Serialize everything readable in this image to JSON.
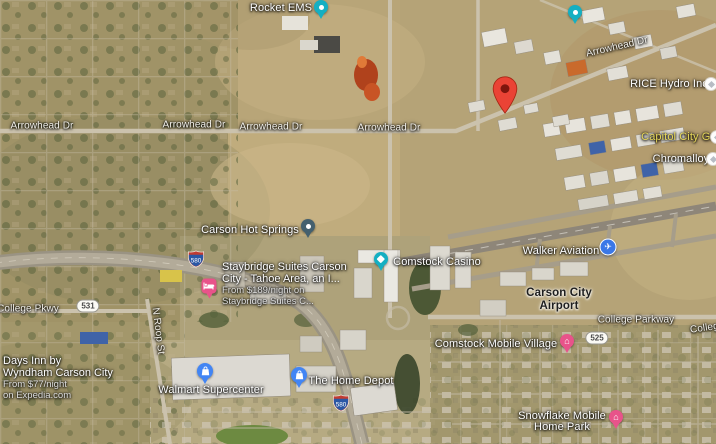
{
  "map_type": "satellite",
  "colors": {
    "marker_red": "#EA4335",
    "pin_teal": "#14afc2",
    "pin_slate": "#44606e",
    "pin_pink": "#e8538a",
    "pin_blue": "#4285f4",
    "poi_circle_blue": "#3b78e7",
    "label_yellow": "#e6d75a",
    "interstate_blue": "#2a57a5",
    "interstate_red": "#c03b31"
  },
  "road_labels": {
    "arrowhead": "Arrowhead Dr",
    "college_pkwy": "College Pkwy",
    "college_parkway": "College Parkway",
    "n_roop_st": "N Roop St"
  },
  "shields": {
    "interstate_580": "580",
    "route_531": "531",
    "route_525": "525"
  },
  "places": {
    "rocket_ems": "Rocket EMS",
    "rice_hydro": "RICE Hydro Inc",
    "capitol_city_gun": "Capitol City Gun",
    "chromalloy": "Chromalloy",
    "carson_hot_springs": "Carson Hot Springs",
    "comstock_casino": "Comstock Casino",
    "walker_aviation": "Walker Aviation",
    "airport_line1": "Carson City",
    "airport_line2": "Airport",
    "comstock_mobile_village": "Comstock Mobile Village",
    "snowflake_line1": "Snowflake Mobile",
    "snowflake_line2": "Home Park",
    "walmart": "Walmart Supercenter",
    "home_depot": "The Home Depot"
  },
  "ads": {
    "staybridge": {
      "title_line1": "Staybridge Suites Carson",
      "title_line2": "City - Tahoe Area, an I...",
      "price_line": "From $189/night on",
      "source_line": "Staybridge Suites C..."
    },
    "days_inn": {
      "title_line1": "Days Inn by",
      "title_line2": "Wyndham Carson City",
      "price_line": "From $77/night",
      "source_line": "on Expedia.com"
    }
  },
  "icons": {
    "airplane": "✈",
    "home": "⌂"
  }
}
